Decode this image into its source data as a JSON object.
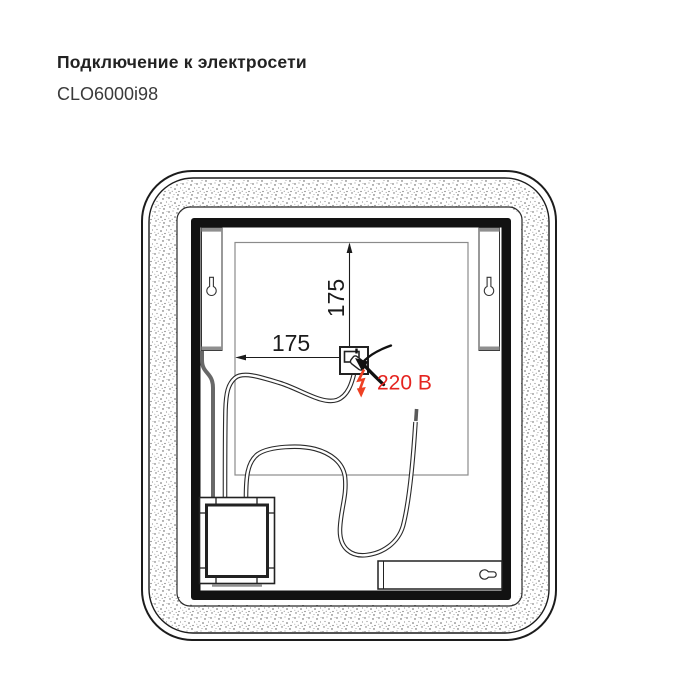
{
  "header": {
    "title": "Подключение к электросети",
    "model": "CLO6000i98"
  },
  "diagram": {
    "horizontal_dimension": "175",
    "vertical_dimension": "175",
    "voltage_label": "220 В",
    "colors": {
      "accent_red": "#e52420",
      "bolt_orange": "#ee4023",
      "line_black": "#1b1b1b",
      "panel_gray": "#8b8b8b",
      "cable_gray": "#686868",
      "bracket_cap_gray": "#8f8f8f"
    },
    "icons": {
      "left_bracket": "keyhole-icon",
      "right_bracket": "keyhole-icon",
      "bottom_slot": "horizontal-keyhole-icon",
      "power_point": "curved-arrow-icon",
      "voltage": "lightning-bolt-icon"
    }
  }
}
